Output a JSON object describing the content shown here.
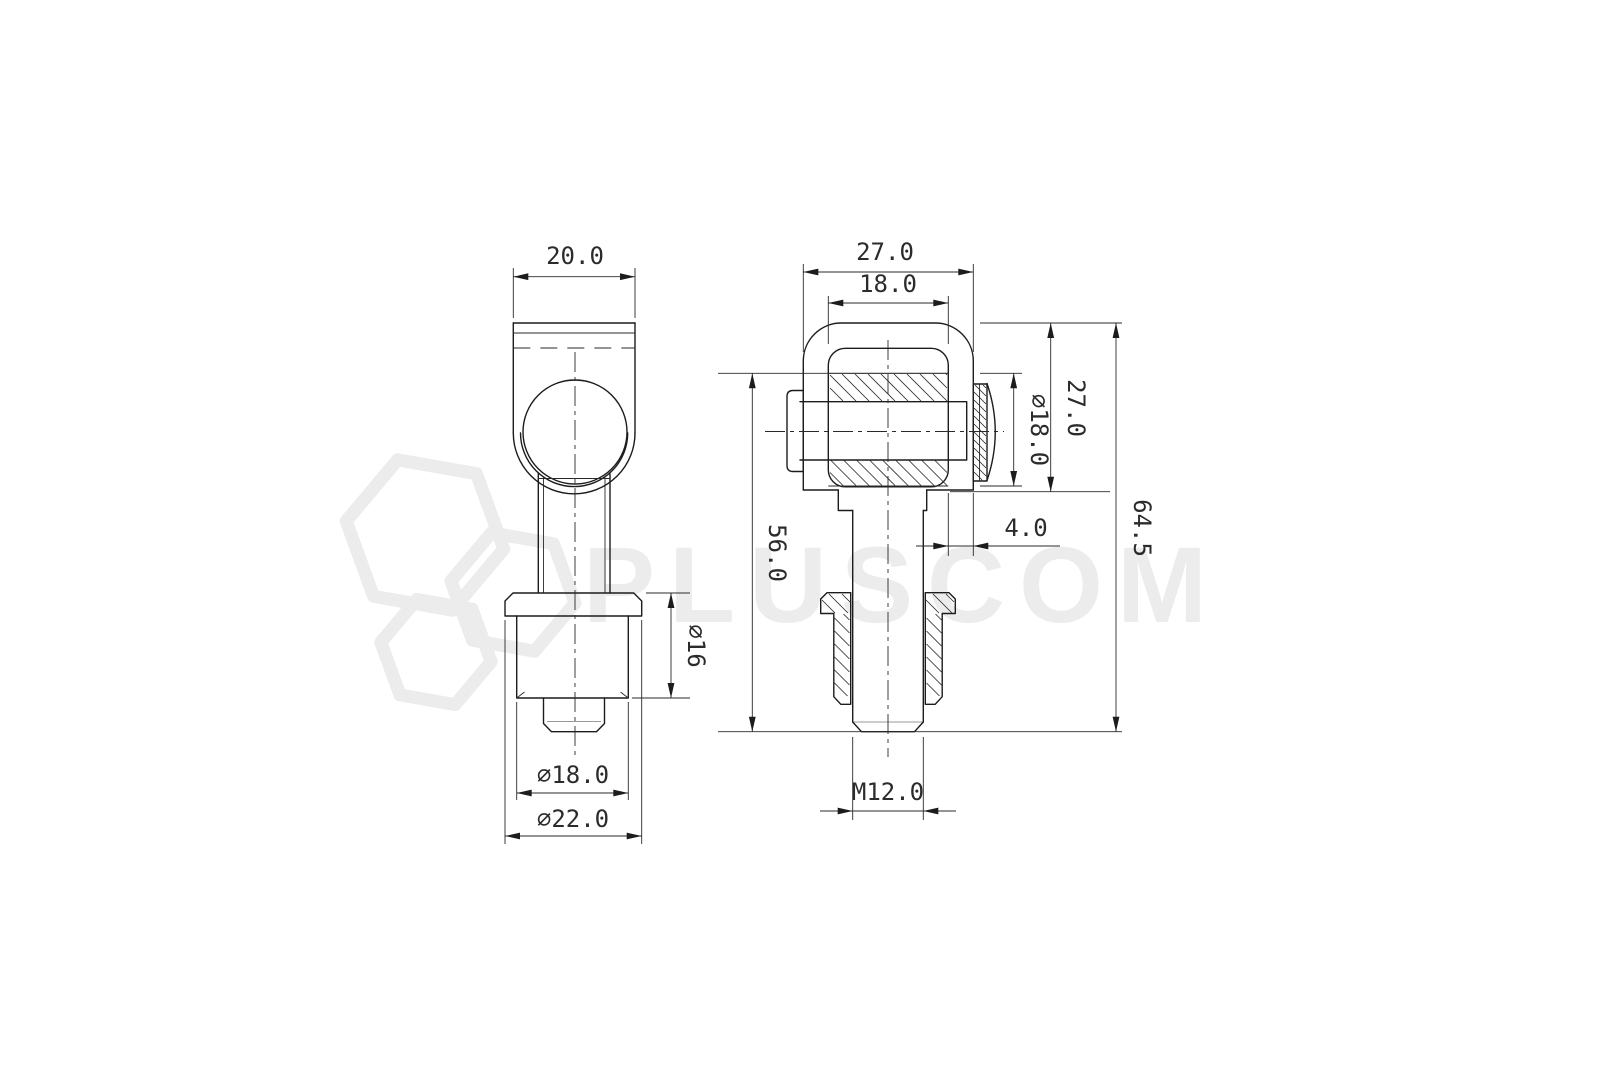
{
  "watermark": {
    "brand": "PLUSCOM",
    "color": "#ececec"
  },
  "drawing": {
    "line_color": "#1c1c1c",
    "side_view": {
      "dims": {
        "clevis_width": "20.0",
        "sleeve_height": "⌀16",
        "bore_dia": "⌀18.0",
        "flange_dia": "⌀22.0"
      }
    },
    "section_view": {
      "dims": {
        "head_width": "27.0",
        "slot_width": "18.0",
        "ball_dia": "⌀18.0",
        "head_height": "27.0",
        "shank_length": "56.0",
        "overall_length": "64.5",
        "cap_offset": "4.0",
        "thread": "M12.0"
      }
    }
  }
}
